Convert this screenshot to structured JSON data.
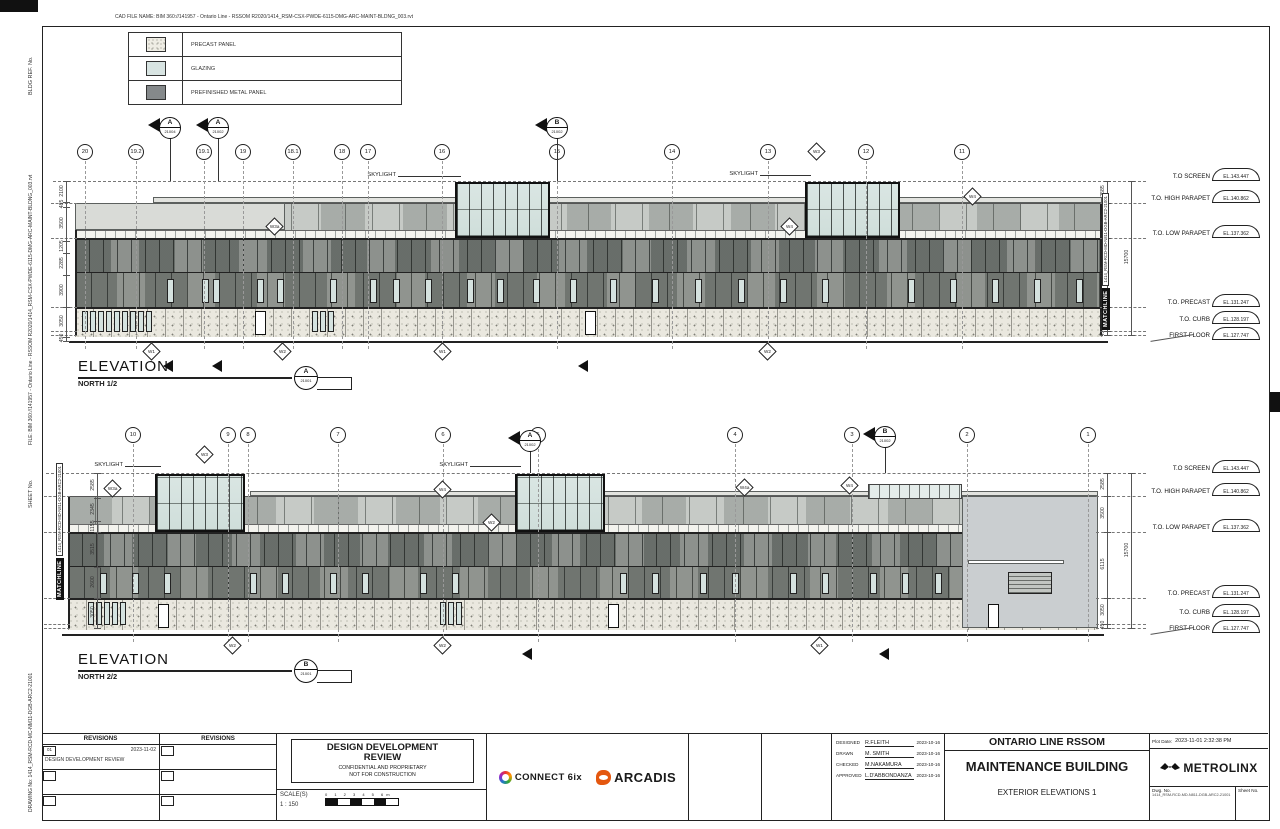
{
  "labels": {
    "skylight": "SKYLIGHT",
    "matchline": "MATCHLINE",
    "matchline_no": "1414_RSM-RCD-MD-N811-DGB-ARC2-21001",
    "elevation": "ELEVATION"
  },
  "margins": {
    "cad_file_name": "CAD FILE NAME: BIM 360://141957 - Ontario Line - RSSOM R2020/1414_RSM-CSX-PWDE-6115-DMG-ARC-MAINT-BLDNG_003.rvt",
    "bldg_ref": "BLDG  REF.  No.",
    "file_bim": "FILE: BIM 360://141957 - Ontario Line - RSSOM R2020/1414_RSM-CSX-PWDE-6115-DMG-ARC-MAINT-BLDNG_003.rvt",
    "sheet_no": "SHEET No.",
    "drawing_no": "DRAWING No: 1414_RSM-RCD-MC-NM11-DGB-ARC2-21001"
  },
  "legend": {
    "items": [
      {
        "label": "PRECAST PANEL",
        "swatch": "precast"
      },
      {
        "label": "GLAZING",
        "swatch": "glazing"
      },
      {
        "label": "PREFINISHED METAL PANEL",
        "swatch": "metal"
      }
    ]
  },
  "colors": {
    "glazing": "#d8e4e2",
    "metal_dark": "#85898b",
    "precast": "#eae8df",
    "arcadis_orange": "#e4570f"
  },
  "level_rows": [
    {
      "label": "T.O SCREEN",
      "el": "EL.143.447",
      "k": "screen"
    },
    {
      "label": "T.O. HIGH PARAPET",
      "el": "EL.140.862",
      "k": "high"
    },
    {
      "label": "T.O. LOW PARAPET",
      "el": "EL.137.362",
      "k": "low"
    },
    {
      "label": "T.O. PRECAST",
      "el": "EL.131.247",
      "k": "precast"
    },
    {
      "label": "T.O. CURB",
      "el": "EL.128.197",
      "k": "curb"
    },
    {
      "label": "FIRST FLOOR",
      "el": "EL.127.747",
      "k": "first"
    }
  ],
  "elevations": [
    {
      "title": {
        "x": 78,
        "y": 358,
        "main": "ELEVATION",
        "sub": "NORTH 1/2",
        "tag_letter": "A",
        "tag_number": "21001",
        "tagx": 294,
        "tagy": 366
      },
      "geom": {
        "top": 152,
        "screen": 181,
        "high": 203,
        "low": 238,
        "mid": 272,
        "precast": 307,
        "first": 335,
        "grade": 341,
        "gbot": 349,
        "fx": 75,
        "fw": 1027,
        "dimx": 66,
        "mlx": 1094,
        "mly": 330
      },
      "grids": [
        {
          "label": "20",
          "x": 85
        },
        {
          "label": "19.2",
          "x": 136
        },
        {
          "label": "19.1",
          "x": 204
        },
        {
          "label": "19",
          "x": 243
        },
        {
          "label": "18.1",
          "x": 293
        },
        {
          "label": "18",
          "x": 342
        },
        {
          "label": "17",
          "x": 368
        },
        {
          "label": "16",
          "x": 442
        },
        {
          "label": "15",
          "x": 557
        },
        {
          "label": "14",
          "x": 672
        },
        {
          "label": "13",
          "x": 768
        },
        {
          "label": "12",
          "x": 866
        },
        {
          "label": "11",
          "x": 962
        }
      ],
      "sections": [
        [
          "A",
          "21004",
          170,
          128
        ],
        [
          "A",
          "21002",
          218,
          128
        ],
        [
          "B",
          "21002",
          557,
          128
        ]
      ],
      "cut_arrows": [
        [
          163,
          360
        ],
        [
          212,
          360
        ],
        [
          578,
          360
        ]
      ],
      "skylights": [
        [
          455,
          95
        ],
        [
          805,
          95
        ]
      ],
      "skylight_labels": [
        [
          398,
          176
        ],
        [
          760,
          175
        ]
      ],
      "overlays": [
        {
          "x": 75,
          "y": 203,
          "w": 210,
          "h": 27,
          "c": "#d9dbd7"
        },
        {
          "x": 153,
          "y": 197,
          "w": 949,
          "h": 6,
          "c": "#e2e3df"
        }
      ],
      "windows": [
        167,
        202,
        213,
        257,
        277,
        330,
        370,
        393,
        425,
        467,
        497,
        533,
        570,
        610,
        652,
        695,
        738,
        780,
        822,
        908,
        950,
        992,
        1034,
        1076
      ],
      "precast_slits": [
        82,
        90,
        98,
        106,
        114,
        122,
        130,
        138,
        146,
        312,
        320,
        328
      ],
      "doors": [
        255,
        585
      ],
      "tags": [
        [
          "W3a",
          275,
          227
        ],
        [
          "W4",
          790,
          227
        ],
        [
          "W3",
          817,
          152
        ],
        [
          "W4",
          973,
          197
        ]
      ],
      "bottom_tags": [
        [
          "W1",
          152,
          352
        ],
        [
          "W2",
          283,
          352
        ],
        [
          "W1",
          443,
          352
        ],
        [
          "W2",
          768,
          352
        ]
      ],
      "left_dims": [
        [
          "2100",
          181,
          202
        ],
        [
          "485",
          202,
          207
        ],
        [
          "3500",
          207,
          241
        ],
        [
          "1205",
          241,
          253
        ],
        [
          "2285",
          253,
          275
        ],
        [
          "3900",
          275,
          307
        ],
        [
          "3050",
          307,
          337
        ],
        [
          "450",
          337,
          341
        ]
      ],
      "right_dims": {
        "segs": [
          [
            "2585",
            "screen",
            "high"
          ],
          [
            "3500",
            "high",
            "low"
          ],
          [
            "6115",
            "low",
            "precast"
          ],
          [
            "3050",
            "precast",
            "curb"
          ],
          [
            "450",
            "curb",
            "first"
          ]
        ],
        "overall": [
          "15700",
          "screen",
          "first"
        ]
      }
    },
    {
      "title": {
        "x": 78,
        "y": 651,
        "main": "ELEVATION",
        "sub": "NORTH 2/2",
        "tag_letter": "B",
        "tag_number": "21001",
        "tagx": 294,
        "tagy": 659
      },
      "geom": {
        "top": 435,
        "screen": 473,
        "high": 496,
        "low": 532,
        "mid": 566,
        "precast": 598,
        "first": 628,
        "grade": 634,
        "gbot": 642,
        "fx": 68,
        "fw": 1030,
        "dimx": 97,
        "mlx": 48,
        "mly": 600
      },
      "grids": [
        {
          "label": "10",
          "x": 133
        },
        {
          "label": "9",
          "x": 228
        },
        {
          "label": "8",
          "x": 248
        },
        {
          "label": "7",
          "x": 338
        },
        {
          "label": "6",
          "x": 443
        },
        {
          "label": "5",
          "x": 538
        },
        {
          "label": "4",
          "x": 735
        },
        {
          "label": "3",
          "x": 852
        },
        {
          "label": "2",
          "x": 967
        },
        {
          "label": "1",
          "x": 1088
        }
      ],
      "sections": [
        [
          "A",
          "21002",
          530,
          441
        ],
        [
          "B",
          "21002",
          885,
          437
        ]
      ],
      "cut_arrows": [
        [
          522,
          648
        ],
        [
          879,
          648
        ]
      ],
      "skylights": [
        [
          155,
          90
        ],
        [
          515,
          90
        ]
      ],
      "skylight_labels": [
        [
          125,
          466
        ],
        [
          470,
          466
        ]
      ],
      "overlays": [
        {
          "x": 250,
          "y": 491,
          "w": 848,
          "h": 5,
          "c": "#e2e3df"
        },
        {
          "x": 868,
          "y": 484,
          "w": 94,
          "h": 15,
          "c": "glz"
        },
        {
          "x": 962,
          "y": 496,
          "w": 136,
          "h": 132,
          "c": "#caced0"
        },
        {
          "x": 968,
          "y": 560,
          "w": 96,
          "h": 4,
          "c": "#ffffff"
        },
        {
          "x": 1008,
          "y": 572,
          "w": 44,
          "h": 22,
          "c": "louver"
        }
      ],
      "windows": [
        100,
        132,
        164,
        250,
        282,
        330,
        362,
        420,
        452,
        620,
        652,
        700,
        732,
        790,
        822,
        870,
        902,
        935
      ],
      "precast_slits": [
        88,
        96,
        104,
        112,
        120,
        440,
        448,
        456
      ],
      "doors": [
        158,
        608,
        988
      ],
      "tags": [
        [
          "W3",
          205,
          455
        ],
        [
          "W4",
          443,
          490
        ],
        [
          "W3a",
          113,
          489
        ],
        [
          "W4a",
          745,
          488
        ],
        [
          "W4",
          850,
          486
        ],
        [
          "W2",
          492,
          523
        ]
      ],
      "bottom_tags": [
        [
          "W2",
          233,
          646
        ],
        [
          "W2",
          443,
          646
        ],
        [
          "W1",
          820,
          646
        ]
      ],
      "left_dims": [
        [
          "2585",
          473,
          498
        ],
        [
          "2345",
          498,
          521
        ],
        [
          "1155",
          521,
          532
        ],
        [
          "3515",
          532,
          567
        ],
        [
          "2600",
          567,
          598
        ],
        [
          "3050",
          598,
          628
        ]
      ],
      "right_dims": {
        "segs": [
          [
            "2585",
            "screen",
            "high"
          ],
          [
            "3500",
            "high",
            "low"
          ],
          [
            "6115",
            "low",
            "precast"
          ],
          [
            "3050",
            "precast",
            "curb"
          ],
          [
            "450",
            "curb",
            "first"
          ]
        ],
        "overall": [
          "15700",
          "screen",
          "first"
        ]
      }
    }
  ],
  "titleblock": {
    "revisions_header_a": "REVISIONS",
    "revisions_header_b": "REVISIONS",
    "revision": {
      "no": "01",
      "date": "2023-11-02",
      "desc": "DESIGN DEVELOPMENT REVIEW"
    },
    "stamp": {
      "line1": "DESIGN DEVELOPMENT",
      "line2": "REVIEW",
      "line3": "CONFIDENTIAL AND PROPRIETARY",
      "line4": "NOT FOR CONSTRUCTION"
    },
    "scale_label": "SCALE(S)",
    "scale_value": "1 : 150",
    "scale_ticks": "0 1 2 3 4 5 6m",
    "logo_connect": "CONNECT 6ix",
    "logo_arcadis": "ARCADIS",
    "credits": {
      "rows": [
        {
          "role": "DESIGNED",
          "name": "R.FLEITH",
          "date": "2023-10-16"
        },
        {
          "role": "DRAWN",
          "name": "M. SMITH",
          "date": "2023-10-16"
        },
        {
          "role": "CHECKED",
          "name": "M.NAKAMURA",
          "date": "2023-10-16"
        },
        {
          "role": "APPROVED",
          "name": "L.D'ABBONDANZA",
          "date": "2023-10-16"
        }
      ]
    },
    "project": {
      "line1": "ONTARIO LINE RSSOM",
      "line2": "MAINTENANCE BUILDING",
      "line3": "EXTERIOR ELEVATIONS 1"
    },
    "plot_label": "Plot Date:",
    "plot_value": "2023-11-01 2:32:38 PM",
    "metrolinx": "METROLINX",
    "dwg_label": "Dwg. No.",
    "dwg_value": "1414_RSM-RCD-MD-N811-DGB-ARC2-21001",
    "sheet_label": "Sheet No."
  }
}
